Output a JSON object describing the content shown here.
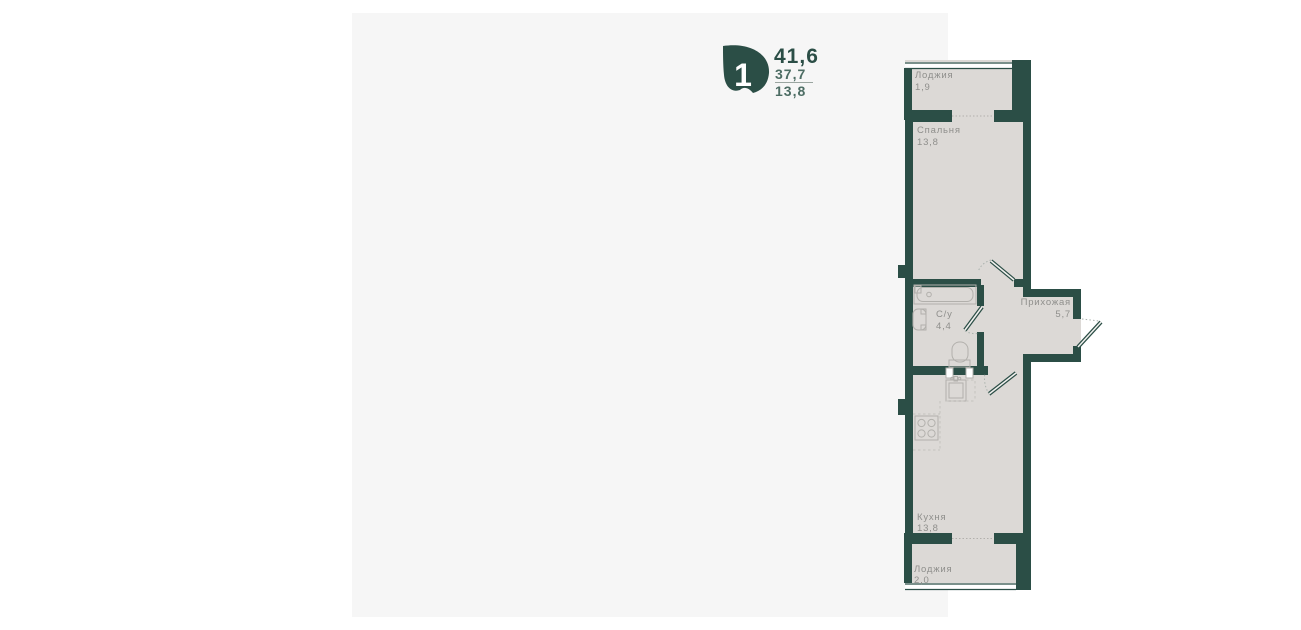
{
  "panel": {
    "background": "#f6f6f6"
  },
  "card": {
    "badge_number": "1",
    "total_area": "41,6",
    "living_area": "37,7",
    "kitchen_area": "13,8",
    "accent_color": "#2b4e46"
  },
  "floor_plan": {
    "colors": {
      "wall": "#2b4e46",
      "floor": "#dcd9d6",
      "label": "#8f8f8c",
      "fixture": "#b2b0ac"
    },
    "rooms": [
      {
        "name": "Лоджия",
        "area": "1,9"
      },
      {
        "name": "Спальня",
        "area": "13,8"
      },
      {
        "name": "С/у",
        "area": "4,4"
      },
      {
        "name": "Прихожая",
        "area": "5,7"
      },
      {
        "name": "Кухня",
        "area": "13,8"
      },
      {
        "name": "Лоджия",
        "area": "2,0"
      }
    ]
  }
}
